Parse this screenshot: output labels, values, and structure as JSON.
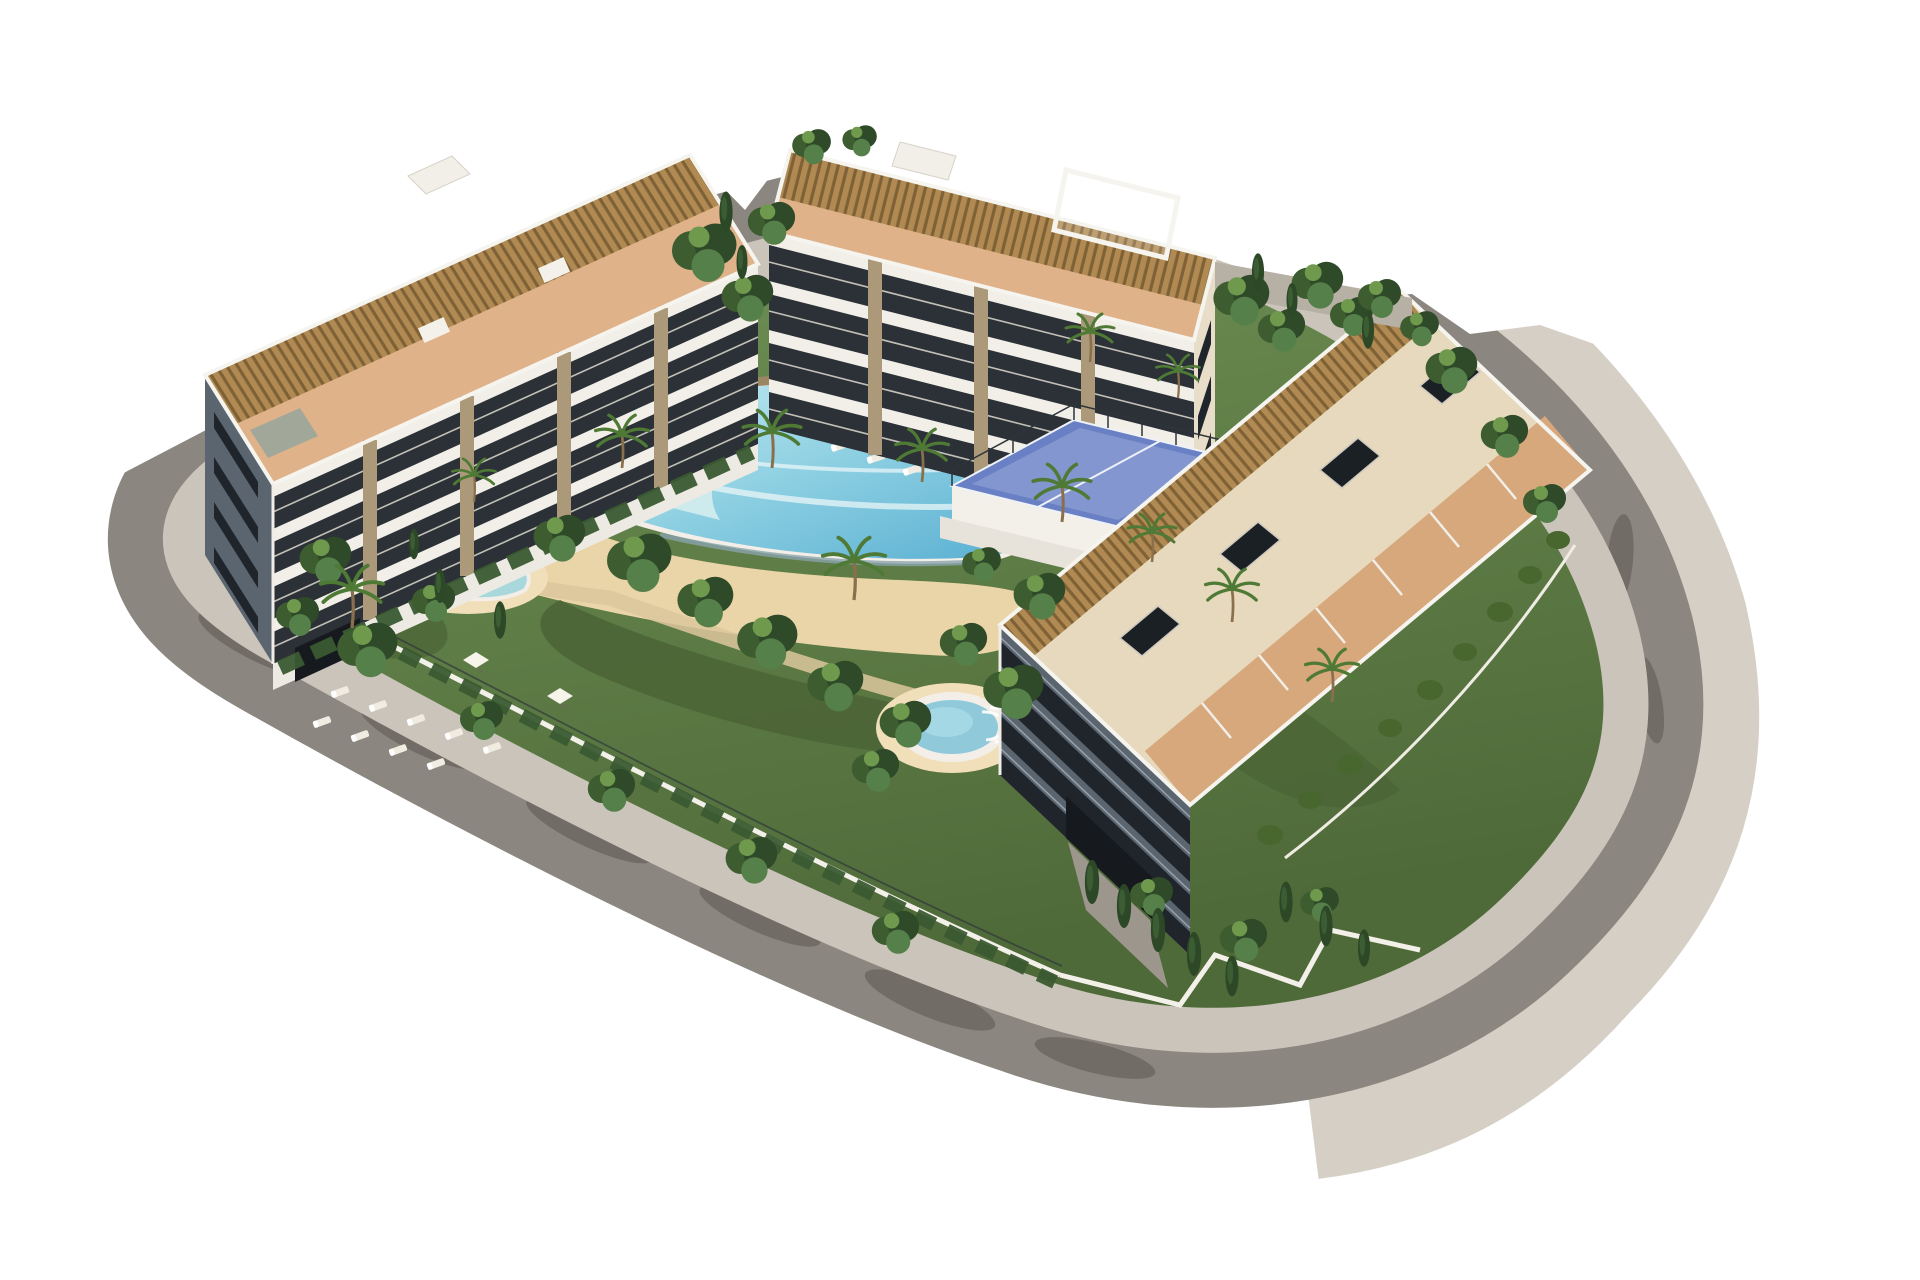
{
  "image": {
    "kind": "3d-architectural-rendering",
    "subject": "Aerial 3D render of a modern white residential apartment complex on a rounded corner plot with a lagoon pool courtyard",
    "background": "#ffffff"
  },
  "colors": {
    "background": "#ffffff",
    "road": "#8b867f",
    "sidewalk": "#cac4bb",
    "outer_sidewalk": "#d6cfc5",
    "lawn": "#5f7d46",
    "lawn_dark": "#4c6536",
    "lawn_light": "#7da05e",
    "sand": "#ead5a8",
    "sand_light": "#f0dfb9",
    "path_beige": "#dcc79c",
    "pool_rim": "#f3efe8",
    "pool_shallow": "#d8eeee",
    "pool_deep": "#57aed2",
    "pool_wall": "#9b8663",
    "spa_water": "#8fc9da",
    "kids_pool_water": "#a8d8dc",
    "building_white": "#f2efe9",
    "building_cream": "#e8ddc8",
    "facade_recess": "#2b3136",
    "facade_shadow": "#5a6570",
    "window_dark": "#1f252a",
    "stone_pier": "#ab997a",
    "terracotta": "#dfb28a",
    "terracotta_deep": "#d8a87d",
    "pergola": "#b08a52",
    "pergola_line": "#7f6136",
    "walkway_cream": "#e6d9bd",
    "padel_court": "#6a80c4",
    "padel_court_light": "#8396cf",
    "padel_line": "#eef2f8",
    "fence_dark": "#2e343a",
    "wall_white": "#f3f0e9",
    "wall_gray": "#b7b0a4",
    "hedge": "#3a5a31",
    "tree_dark": "#2f4a28",
    "tree_mid": "#47672f",
    "tree_light": "#6f9a4e",
    "cypress": "#2c4827",
    "palm_frond": "#4e7a35",
    "trunk": "#8a6f4d",
    "lounger": "#f1ece1",
    "umbrella": "#f7f4ec",
    "garage_dark": "#16191d",
    "ramp_gray": "#9d968d",
    "shadow": "#2a2724"
  },
  "scene": {
    "buildings": [
      {
        "name": "west-block",
        "floors": 4,
        "features": "white slab balconies, stone piers, shadowed end wall with window bands, rooftop slatted pergolas and terracotta terraces, stair bulkhead, garage door"
      },
      {
        "name": "north-block",
        "floors": 4,
        "features": "white slab balconies facing the pool, cream sunlit end wall, rooftop pergolas and white pergola frame"
      },
      {
        "name": "east-block",
        "floors": 4,
        "features": "long roof with slatted pergola strip, cream walkway, dark skylight boxes, terracotta street-side terraces, shadowed garden facade, garage entrance and ramp"
      }
    ],
    "amenities": [
      "lagoon pool with infinity edge and wave crests",
      "children's pool",
      "round spa pool with steps",
      "sand beach deck",
      "two padel courts on a raised terrace",
      "sun lounger rows",
      "square white parasols",
      "palm trees, leafy trees and cypress hedges",
      "white garden walls with mesh fence"
    ],
    "surroundings": [
      "curved perimeter road with inner and outer sidewalks",
      "tree shadows cast on the asphalt",
      "white background"
    ]
  },
  "counts": {
    "buildings": 3,
    "pools": 3,
    "padel_courts": 2,
    "lounger_rows": 4
  }
}
